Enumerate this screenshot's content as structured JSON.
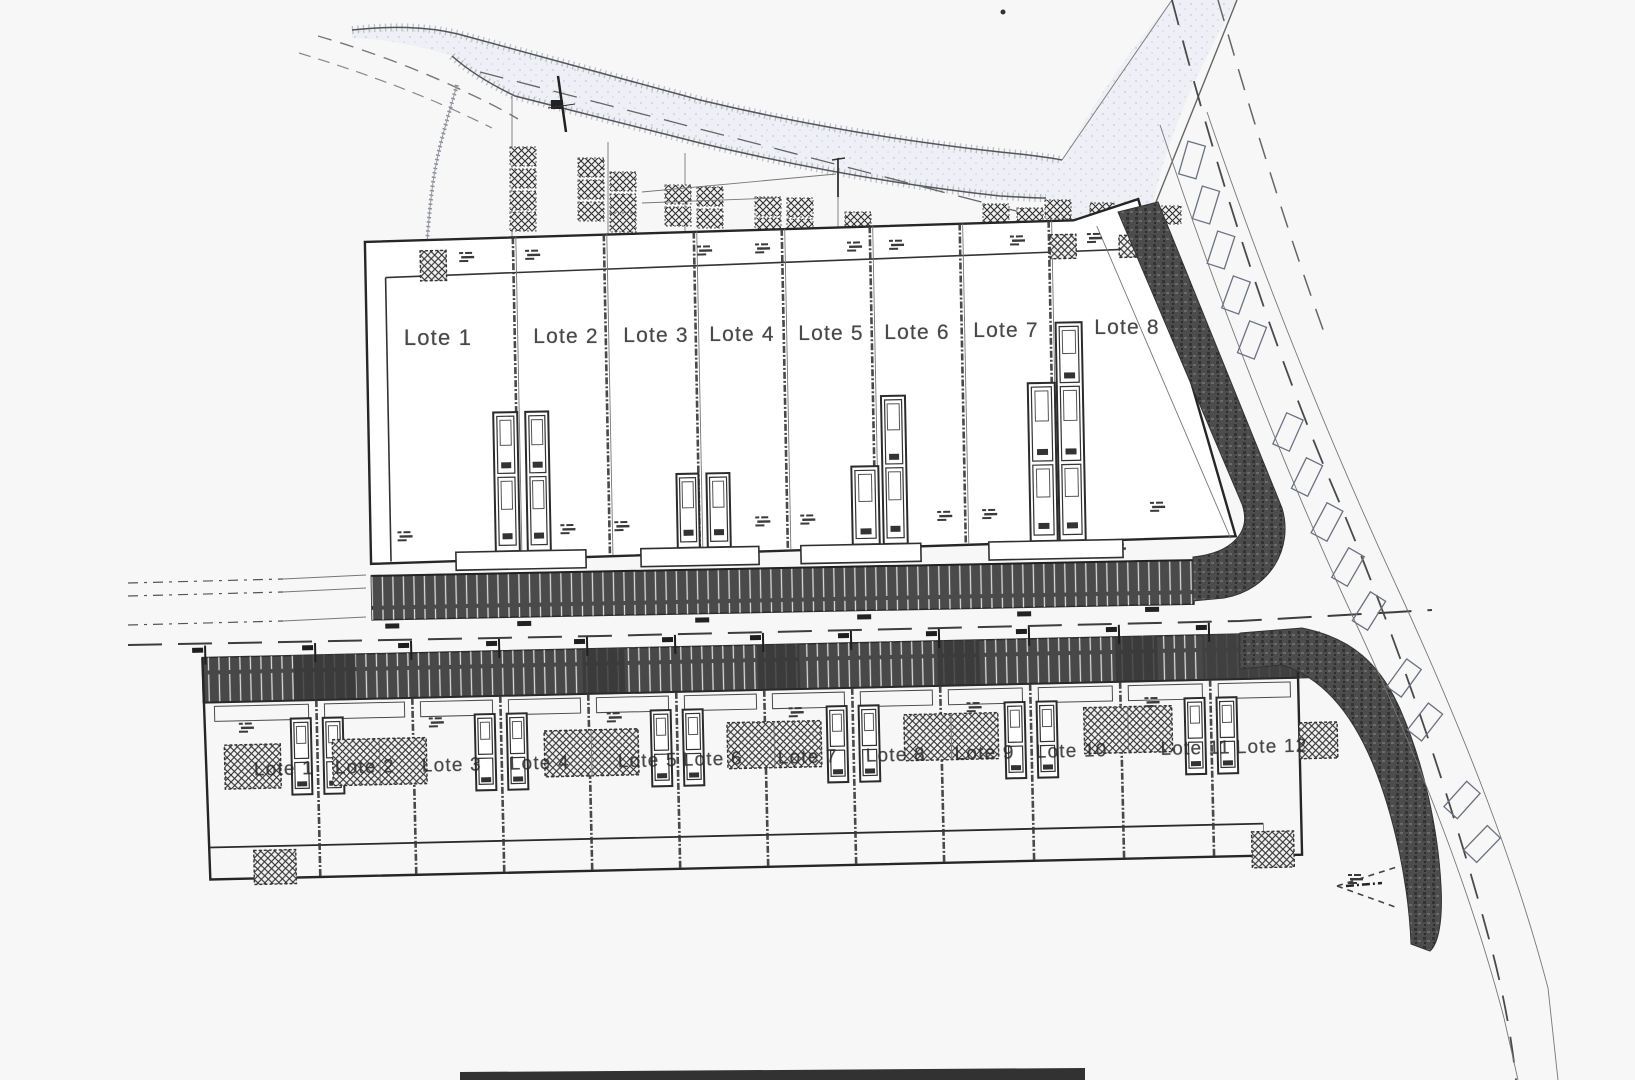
{
  "plan": {
    "upper_block": {
      "lots": [
        {
          "label": "Lote 1"
        },
        {
          "label": "Lote 2"
        },
        {
          "label": "Lote 3"
        },
        {
          "label": "Lote 4"
        },
        {
          "label": "Lote 5"
        },
        {
          "label": "Lote 6"
        },
        {
          "label": "Lote 7"
        },
        {
          "label": "Lote 8"
        }
      ]
    },
    "lower_block": {
      "lots": [
        {
          "label": "Lote 1"
        },
        {
          "label": "Lote 2"
        },
        {
          "label": "Lote 3"
        },
        {
          "label": "Lote 4"
        },
        {
          "label": "Lote 5"
        },
        {
          "label": "Lote 6"
        },
        {
          "label": "Lote 7"
        },
        {
          "label": "Lote 8"
        },
        {
          "label": "Lote 9"
        },
        {
          "label": "Lote 10"
        },
        {
          "label": "Lote 11"
        },
        {
          "label": "Lote 12"
        }
      ]
    },
    "colors": {
      "paper": "#f7f7f8",
      "ink": "#2b2b2b",
      "dark": "#4a4a4a",
      "road": "#eef0f6"
    }
  }
}
